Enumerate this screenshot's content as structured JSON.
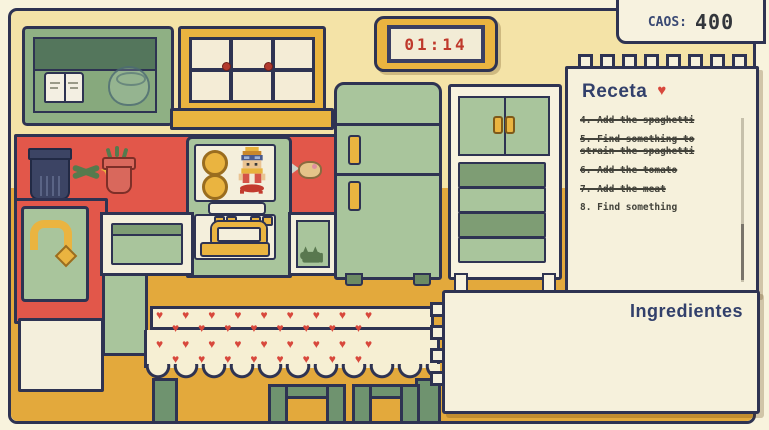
{
  "hud": {
    "caos_label": "CAOS:",
    "caos_value": "400",
    "clock_time": "01:14"
  },
  "recipe": {
    "title": "Receta",
    "items": [
      {
        "text": "4. Add the spaghetti",
        "done": true
      },
      {
        "text": "5. Find something to strain the spaghetti",
        "done": true
      },
      {
        "text": "6. Add the tomato",
        "done": true
      },
      {
        "text": "7. Add the meat",
        "done": true
      },
      {
        "text": "8. Find something",
        "done": false
      }
    ]
  },
  "ingredients": {
    "title": "Ingredientes"
  },
  "decor": {
    "heart_glyph": "♥",
    "sparkle_glyph": "✦"
  },
  "icons": {
    "recipe_heart": "heart-icon",
    "flower_sparkle": "sparkle-icon"
  },
  "colors": {
    "wall": "#f4e3a7",
    "floor": "#e3a93c",
    "counter_red": "#e2574a",
    "appliance_green": "#a9c59c",
    "drawer_green_dark": "#7e9d74",
    "gold": "#eab440",
    "outline_navy": "#2e3352",
    "paper_cream": "#f6f1dc",
    "heart_red": "#d8483c",
    "clock_digit_red": "#bf392c",
    "text_navy": "#32406b"
  }
}
